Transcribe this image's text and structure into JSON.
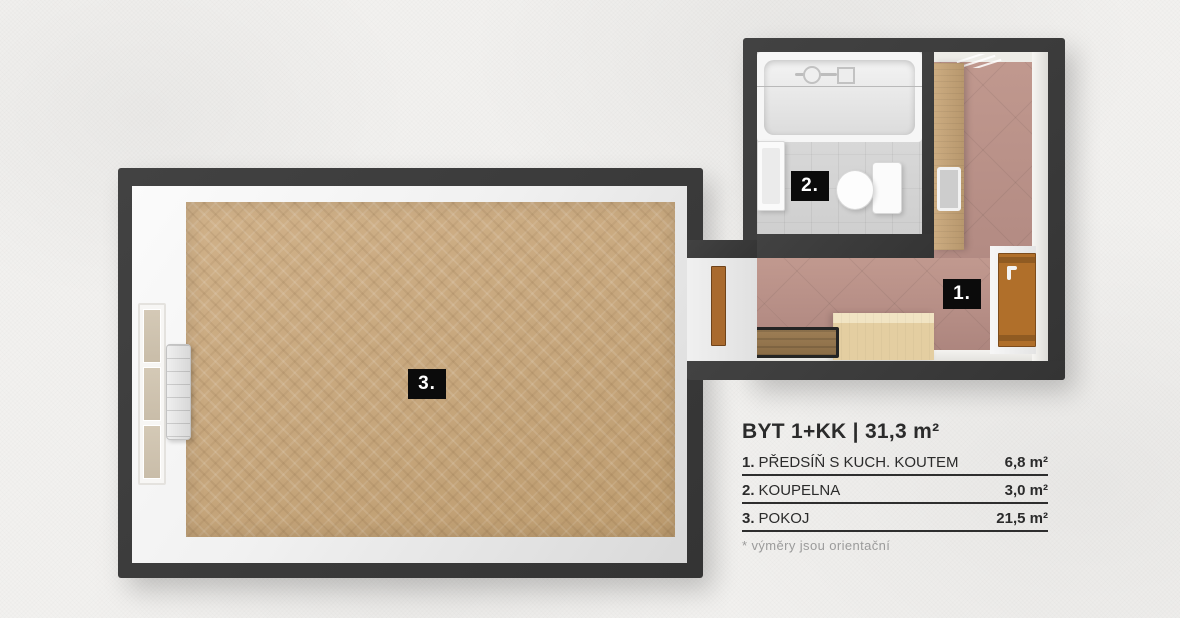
{
  "plan": {
    "labels": {
      "room1": "1.",
      "room2": "2.",
      "room3": "3."
    },
    "fixtures": [
      "bathtub",
      "sink",
      "toilet",
      "wardrobe",
      "mirror",
      "entrance-door",
      "interior-door",
      "kitchen-counter",
      "bench",
      "window",
      "radiator",
      "ceiling-vent"
    ],
    "colors": {
      "wall": "#3a3a3a",
      "parquet_floor": "#c6a67c",
      "hall_tile_floor": "#b48c84",
      "bath_tile_floor": "#d6d6d6",
      "door_wood": "#b06f2a",
      "label_bg": "#0b0b0b",
      "background": "#f2f1ef"
    }
  },
  "legend": {
    "title": "BYT 1+KK | 31,3 m²",
    "rows": [
      {
        "num": "1.",
        "name": "PŘEDSÍŇ S KUCH. KOUTEM",
        "area": "6,8 m²"
      },
      {
        "num": "2.",
        "name": "KOUPELNA",
        "area": "3,0 m²"
      },
      {
        "num": "3.",
        "name": "POKOJ",
        "area": "21,5 m²"
      }
    ],
    "note": "* výměry jsou orientační"
  }
}
